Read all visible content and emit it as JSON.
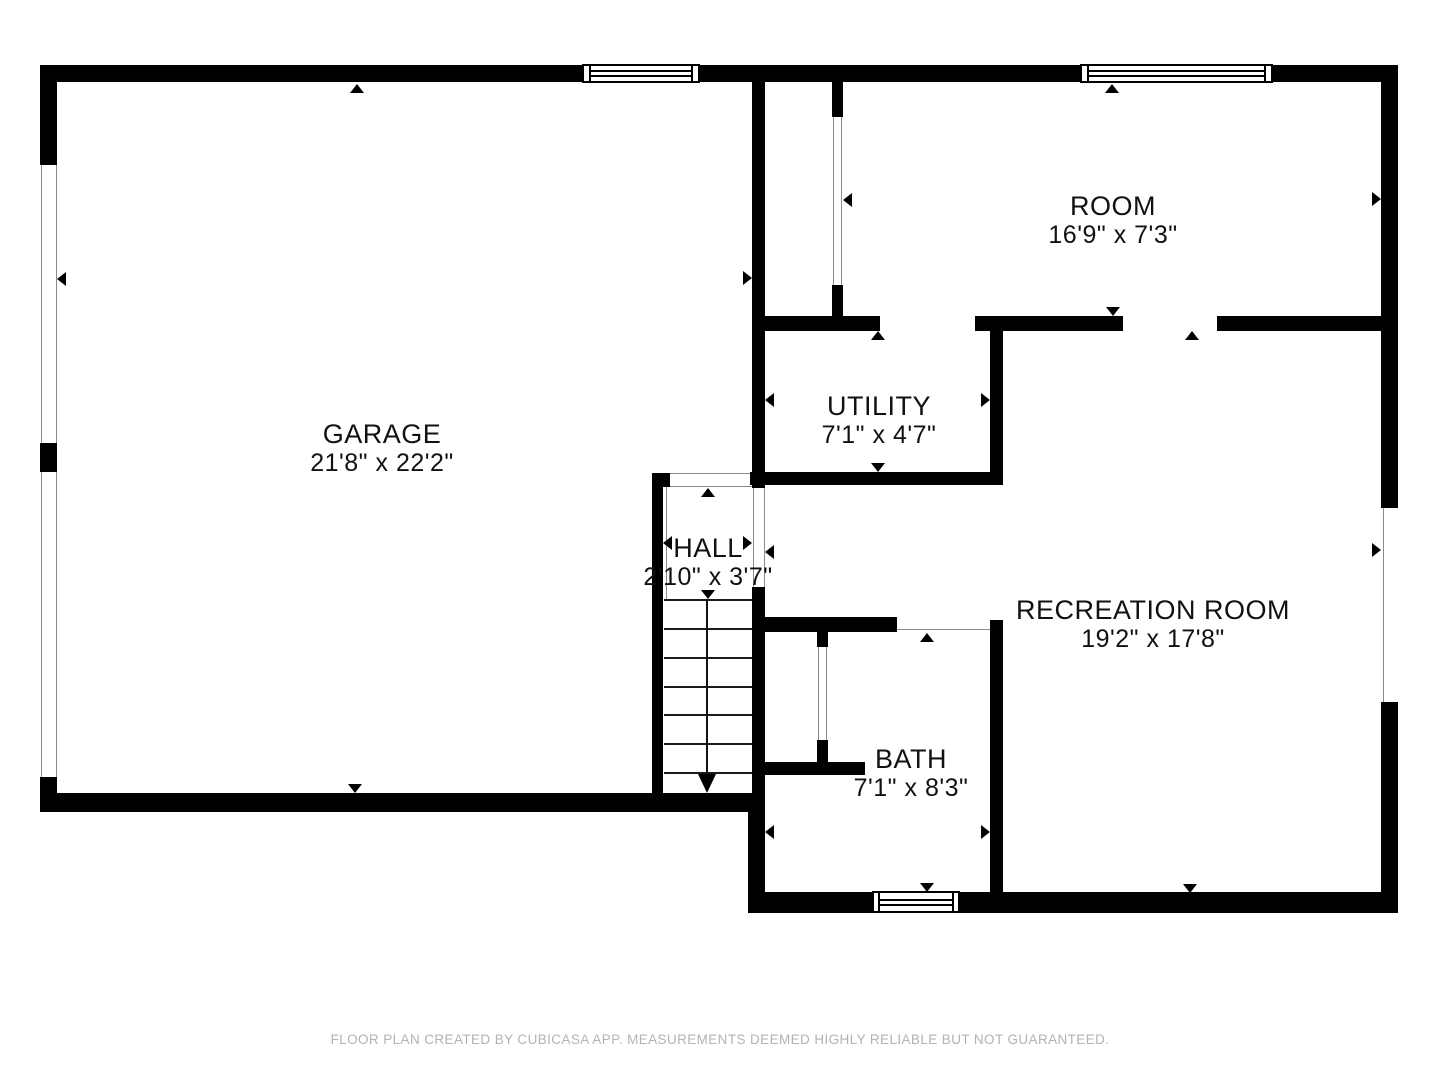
{
  "rooms": {
    "garage": {
      "name": "GARAGE",
      "dimensions": "21'8\" x 22'2\""
    },
    "room": {
      "name": "ROOM",
      "dimensions": "16'9\" x 7'3\""
    },
    "utility": {
      "name": "UTILITY",
      "dimensions": "7'1\" x 4'7\""
    },
    "hall": {
      "name": "HALL",
      "dimensions": "2'10\" x 3'7\""
    },
    "recreation": {
      "name": "RECREATION ROOM",
      "dimensions": "19'2\" x 17'8\""
    },
    "bath": {
      "name": "BATH",
      "dimensions": "7'1\" x 8'3\""
    }
  },
  "footer": {
    "disclaimer": "FLOOR PLAN CREATED BY CUBICASA APP. MEASUREMENTS DEEMED HIGHLY RELIABLE BUT NOT GUARANTEED."
  },
  "colors": {
    "wall": "#000000",
    "background": "#ffffff",
    "footer_text": "#b3b3b3"
  }
}
